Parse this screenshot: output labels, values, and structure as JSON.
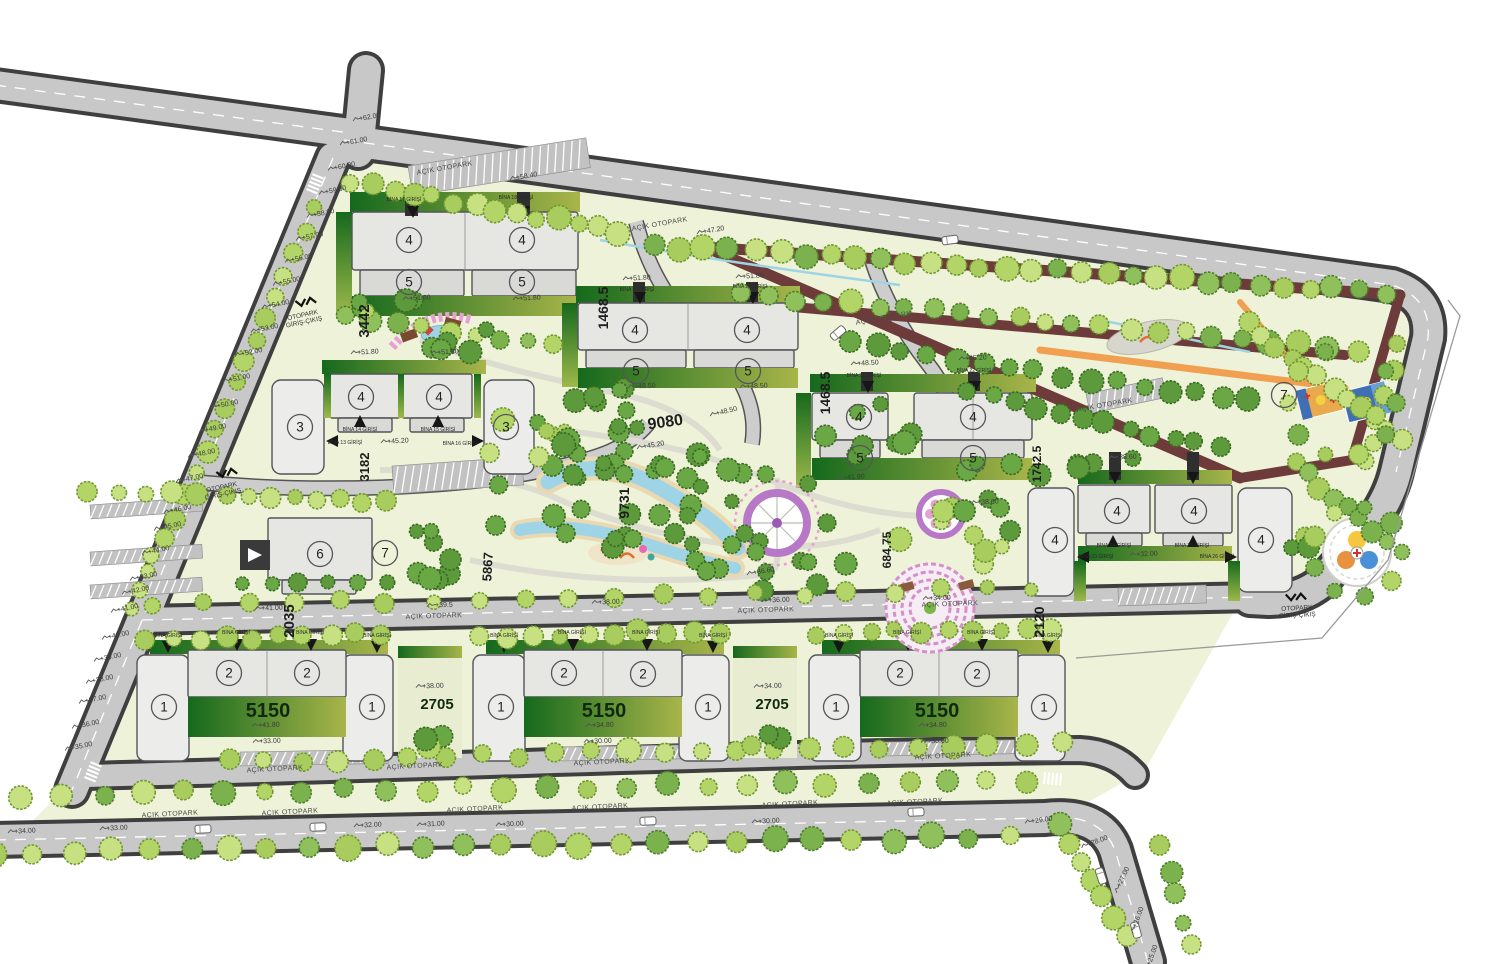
{
  "plan_title": "Site master plan",
  "palette": {
    "road_fill": "#c8c8c8",
    "road_casing": "#3f3f3f",
    "ground": "#eef2d8",
    "building": "#e6e6e3",
    "building_stroke": "#54545a",
    "lawn_dark": "#1b7a1f",
    "lawn_light": "#a4b84a",
    "track": "#6e3b3b",
    "orange_path": "#f0a050",
    "water": "#9fd4e6",
    "tree_lime": "#b9d977",
    "tree_green": "#7cb24e",
    "tree_dark": "#5c9a3c",
    "plaza_ring": "#b878c8",
    "flower_pink": "#e8a0d4"
  },
  "labels": {
    "elevations": [
      {
        "t": "+62.00",
        "x": 370,
        "y": 119,
        "r": -10
      },
      {
        "t": "+61.00",
        "x": 357,
        "y": 143,
        "r": -10
      },
      {
        "t": "+60.00",
        "x": 345,
        "y": 168,
        "r": -12
      },
      {
        "t": "+59.00",
        "x": 336,
        "y": 192,
        "r": -12
      },
      {
        "t": "+58.00",
        "x": 324,
        "y": 215,
        "r": -12
      },
      {
        "t": "+57.00",
        "x": 313,
        "y": 238,
        "r": -12
      },
      {
        "t": "+56.00",
        "x": 302,
        "y": 260,
        "r": -12
      },
      {
        "t": "+55.00",
        "x": 290,
        "y": 283,
        "r": -12
      },
      {
        "t": "+54.00",
        "x": 279,
        "y": 306,
        "r": -12
      },
      {
        "t": "+53.00",
        "x": 268,
        "y": 330,
        "r": -12
      },
      {
        "t": "+52.00",
        "x": 252,
        "y": 354,
        "r": -12
      },
      {
        "t": "+51.00",
        "x": 240,
        "y": 380,
        "r": -12
      },
      {
        "t": "+50.00",
        "x": 228,
        "y": 406,
        "r": -12
      },
      {
        "t": "+49.00",
        "x": 216,
        "y": 430,
        "r": -12
      },
      {
        "t": "+48.00",
        "x": 205,
        "y": 455,
        "r": -12
      },
      {
        "t": "+47.00",
        "x": 193,
        "y": 480,
        "r": -12
      },
      {
        "t": "+46.00",
        "x": 181,
        "y": 511,
        "r": -12
      },
      {
        "t": "+45.00",
        "x": 171,
        "y": 528,
        "r": -12
      },
      {
        "t": "+44.00",
        "x": 159,
        "y": 552,
        "r": -12
      },
      {
        "t": "+43.00",
        "x": 147,
        "y": 578,
        "r": -12
      },
      {
        "t": "+42.00",
        "x": 139,
        "y": 592,
        "r": -12
      },
      {
        "t": "+41.00",
        "x": 128,
        "y": 610,
        "r": -12
      },
      {
        "t": "+40.00",
        "x": 119,
        "y": 637,
        "r": -12
      },
      {
        "t": "+39.00",
        "x": 111,
        "y": 659,
        "r": -12
      },
      {
        "t": "+38.00",
        "x": 103,
        "y": 681,
        "r": -12
      },
      {
        "t": "+37.00",
        "x": 96,
        "y": 701,
        "r": -12
      },
      {
        "t": "+36.00",
        "x": 89,
        "y": 726,
        "r": -12
      },
      {
        "t": "+35.00",
        "x": 82,
        "y": 748,
        "r": -12
      },
      {
        "t": "+34.00",
        "x": 25,
        "y": 833,
        "r": -3
      },
      {
        "t": "+33.00",
        "x": 117,
        "y": 830,
        "r": -3
      },
      {
        "t": "+32.00",
        "x": 371,
        "y": 827,
        "r": -3
      },
      {
        "t": "+31.00",
        "x": 434,
        "y": 826,
        "r": -3
      },
      {
        "t": "+30.00",
        "x": 513,
        "y": 826,
        "r": -3
      },
      {
        "t": "+30.00",
        "x": 769,
        "y": 823,
        "r": -3
      },
      {
        "t": "+29.00",
        "x": 1042,
        "y": 822,
        "r": -8
      },
      {
        "t": "+28.00",
        "x": 1098,
        "y": 843,
        "r": -20
      },
      {
        "t": "+27.00",
        "x": 1125,
        "y": 878,
        "r": -65
      },
      {
        "t": "+26.00",
        "x": 1140,
        "y": 918,
        "r": -70
      },
      {
        "t": "+25.00",
        "x": 1154,
        "y": 956,
        "r": -70
      },
      {
        "t": "+41.00",
        "x": 272,
        "y": 610,
        "r": -2
      },
      {
        "t": "+39.5",
        "x": 444,
        "y": 607,
        "r": -2
      },
      {
        "t": "+38.00",
        "x": 609,
        "y": 604,
        "r": -2
      },
      {
        "t": "+36.00",
        "x": 779,
        "y": 602,
        "r": -2
      },
      {
        "t": "+34.00",
        "x": 940,
        "y": 600,
        "r": -2
      },
      {
        "t": "+58.40",
        "x": 527,
        "y": 178,
        "r": -10
      },
      {
        "t": "+47.20",
        "x": 714,
        "y": 232,
        "r": -10
      },
      {
        "t": "+51.80",
        "x": 420,
        "y": 300,
        "r": -3
      },
      {
        "t": "+51.80",
        "x": 530,
        "y": 300,
        "r": -3
      },
      {
        "t": "+51.80",
        "x": 640,
        "y": 280,
        "r": -3
      },
      {
        "t": "+51.80",
        "x": 753,
        "y": 278,
        "r": -3
      },
      {
        "t": "+51.80",
        "x": 368,
        "y": 354,
        "r": -3
      },
      {
        "t": "+51.80",
        "x": 448,
        "y": 354,
        "r": -3
      },
      {
        "t": "+48.50",
        "x": 645,
        "y": 388,
        "r": -3
      },
      {
        "t": "+48.50",
        "x": 757,
        "y": 388,
        "r": -3
      },
      {
        "t": "+48.50",
        "x": 727,
        "y": 413,
        "r": -14
      },
      {
        "t": "+45.20",
        "x": 398,
        "y": 443,
        "r": -3
      },
      {
        "t": "+45.20",
        "x": 654,
        "y": 447,
        "r": -10
      },
      {
        "t": "+48.50",
        "x": 868,
        "y": 365,
        "r": -3
      },
      {
        "t": "+45.20",
        "x": 976,
        "y": 360,
        "r": -3
      },
      {
        "t": "+41.90",
        "x": 854,
        "y": 479,
        "r": -3
      },
      {
        "t": "+38.60",
        "x": 988,
        "y": 504,
        "r": -3
      },
      {
        "t": "+38.60",
        "x": 1126,
        "y": 459,
        "r": -3
      },
      {
        "t": "+36.60",
        "x": 764,
        "y": 573,
        "r": -10
      },
      {
        "t": "+32.00",
        "x": 1147,
        "y": 556,
        "r": -3
      },
      {
        "t": "+41.80",
        "x": 269,
        "y": 727,
        "r": -2
      },
      {
        "t": "+33.00",
        "x": 270,
        "y": 743,
        "r": -2
      },
      {
        "t": "+34.80",
        "x": 603,
        "y": 727,
        "r": -2
      },
      {
        "t": "+30.00",
        "x": 601,
        "y": 743,
        "r": -2
      },
      {
        "t": "+34.80",
        "x": 936,
        "y": 727,
        "r": -2
      },
      {
        "t": "+30.60",
        "x": 938,
        "y": 743,
        "r": -2
      },
      {
        "t": "+38.00",
        "x": 433,
        "y": 688,
        "r": -2
      },
      {
        "t": "+34.00",
        "x": 771,
        "y": 688,
        "r": -2
      }
    ],
    "parking": [
      {
        "t": "AÇIK OTOPARK",
        "x": 445,
        "y": 170,
        "r": -10
      },
      {
        "t": "AÇIK OTOPARK",
        "x": 660,
        "y": 226,
        "r": -10
      },
      {
        "t": "AÇIK OTOPARK",
        "x": 884,
        "y": 320,
        "r": -10
      },
      {
        "t": "AÇIK OTOPARK",
        "x": 1105,
        "y": 407,
        "r": -10
      },
      {
        "t": "AÇIK OTOPARK",
        "x": 434,
        "y": 618,
        "r": -2
      },
      {
        "t": "AÇIK OTOPARK",
        "x": 766,
        "y": 612,
        "r": -2
      },
      {
        "t": "AÇIK OTOPARK",
        "x": 950,
        "y": 606,
        "r": -2
      },
      {
        "t": "AÇIK OTOPARK",
        "x": 275,
        "y": 771,
        "r": -3
      },
      {
        "t": "AÇIK OTOPARK",
        "x": 415,
        "y": 768,
        "r": -3
      },
      {
        "t": "AÇIK OTOPARK",
        "x": 602,
        "y": 764,
        "r": -3
      },
      {
        "t": "AÇIK OTOPARK",
        "x": 943,
        "y": 758,
        "r": -3
      },
      {
        "t": "AÇIK OTOPARK",
        "x": 170,
        "y": 816,
        "r": -3
      },
      {
        "t": "AÇIK OTOPARK",
        "x": 290,
        "y": 814,
        "r": -3
      },
      {
        "t": "AÇIK OTOPARK",
        "x": 475,
        "y": 811,
        "r": -3
      },
      {
        "t": "AÇIK OTOPARK",
        "x": 600,
        "y": 809,
        "r": -3
      },
      {
        "t": "AÇIK OTOPARK",
        "x": 790,
        "y": 806,
        "r": -3
      },
      {
        "t": "AÇIK OTOPARK",
        "x": 915,
        "y": 804,
        "r": -3
      }
    ],
    "gates": [
      {
        "l1": "OTOPARK",
        "l2": "GİRİŞ-ÇIKIŞ",
        "x": 303,
        "y": 317,
        "r": -12
      },
      {
        "l1": "OTOPARK",
        "l2": "GİRİŞ-ÇIKIŞ",
        "x": 222,
        "y": 489,
        "r": -12
      },
      {
        "l1": "OTOPARK",
        "l2": "GİRİŞ-ÇIKIŞ",
        "x": 1297,
        "y": 610,
        "r": -3
      }
    ],
    "entrances": [
      {
        "t": "BİNA 17 GİRİŞİ",
        "x": 404,
        "y": 201
      },
      {
        "t": "BİNA 18 GİRİŞİ",
        "x": 516,
        "y": 199
      },
      {
        "t": "BİNA 19 GİRİŞİ",
        "x": 637,
        "y": 291
      },
      {
        "t": "BİNA 20 GİRİŞİ",
        "x": 750,
        "y": 288
      },
      {
        "t": "BİNA 21 GİRİŞİ",
        "x": 864,
        "y": 377
      },
      {
        "t": "BİNA 22 GİRİŞİ",
        "x": 974,
        "y": 372
      },
      {
        "t": "BİNA 13 GİRİŞİ",
        "x": 345,
        "y": 444
      },
      {
        "t": "BİNA 14 GİRİŞİ",
        "x": 360,
        "y": 431
      },
      {
        "t": "BİNA 15 GİRİŞİ",
        "x": 438,
        "y": 431
      },
      {
        "t": "BİNA 16 GİRİŞİ",
        "x": 460,
        "y": 445
      },
      {
        "t": "BİNA 23 GİRİŞİ",
        "x": 1096,
        "y": 558
      },
      {
        "t": "BİNA 24 GİRİŞİ",
        "x": 1114,
        "y": 547
      },
      {
        "t": "BİNA 25 GİRİŞİ",
        "x": 1192,
        "y": 547
      },
      {
        "t": "BİNA 26 GİRİŞİ",
        "x": 1217,
        "y": 558
      },
      {
        "t": "BİNA GİRİŞİ",
        "x": 168,
        "y": 637
      },
      {
        "t": "BİNA GİRİŞİ",
        "x": 236,
        "y": 634
      },
      {
        "t": "BİNA GİRİŞİ",
        "x": 310,
        "y": 634
      },
      {
        "t": "BİNA GİRİŞİ",
        "x": 377,
        "y": 637
      },
      {
        "t": "BİNA GİRİŞİ",
        "x": 504,
        "y": 637
      },
      {
        "t": "BİNA GİRİŞİ",
        "x": 572,
        "y": 634
      },
      {
        "t": "BİNA GİRİŞİ",
        "x": 646,
        "y": 634
      },
      {
        "t": "BİNA GİRİŞİ",
        "x": 713,
        "y": 637
      },
      {
        "t": "BİNA GİRİŞİ",
        "x": 839,
        "y": 637
      },
      {
        "t": "BİNA GİRİŞİ",
        "x": 907,
        "y": 634
      },
      {
        "t": "BİNA GİRİŞİ",
        "x": 981,
        "y": 634
      },
      {
        "t": "BİNA GİRİŞİ",
        "x": 1048,
        "y": 637
      }
    ],
    "areas": [
      {
        "t": "3442",
        "x": 369,
        "y": 321,
        "r": -90,
        "s": 15
      },
      {
        "t": "1468.5",
        "x": 608,
        "y": 308,
        "r": -90,
        "s": 14
      },
      {
        "t": "1468.5",
        "x": 830,
        "y": 393,
        "r": -90,
        "s": 14
      },
      {
        "t": "9080",
        "x": 666,
        "y": 427,
        "r": -8,
        "s": 16
      },
      {
        "t": "9731",
        "x": 629,
        "y": 503,
        "r": -90,
        "s": 14
      },
      {
        "t": "5867",
        "x": 492,
        "y": 567,
        "r": -87,
        "s": 13
      },
      {
        "t": "2035",
        "x": 294,
        "y": 621,
        "r": -90,
        "s": 15
      },
      {
        "t": "684.75",
        "x": 891,
        "y": 550,
        "r": -90,
        "s": 12
      },
      {
        "t": "1742.5",
        "x": 1041,
        "y": 464,
        "r": -90,
        "s": 12
      },
      {
        "t": "2120",
        "x": 1044,
        "y": 622,
        "r": -90,
        "s": 14
      },
      {
        "t": "3182",
        "x": 369,
        "y": 467,
        "r": -90,
        "s": 13
      }
    ],
    "strips": [
      {
        "t": "5150",
        "x": 268,
        "y": 717,
        "s": 20
      },
      {
        "t": "5150",
        "x": 604,
        "y": 717,
        "s": 20
      },
      {
        "t": "5150",
        "x": 937,
        "y": 717,
        "s": 20
      },
      {
        "t": "2705",
        "x": 437,
        "y": 709,
        "s": 15
      },
      {
        "t": "2705",
        "x": 772,
        "y": 709,
        "s": 15
      }
    ],
    "units": [
      {
        "t": "4",
        "x": 409,
        "y": 240
      },
      {
        "t": "4",
        "x": 522,
        "y": 240
      },
      {
        "t": "5",
        "x": 409,
        "y": 282
      },
      {
        "t": "5",
        "x": 522,
        "y": 282
      },
      {
        "t": "4",
        "x": 635,
        "y": 330
      },
      {
        "t": "4",
        "x": 747,
        "y": 330
      },
      {
        "t": "5",
        "x": 636,
        "y": 371
      },
      {
        "t": "5",
        "x": 748,
        "y": 371
      },
      {
        "t": "3",
        "x": 300,
        "y": 427
      },
      {
        "t": "4",
        "x": 361,
        "y": 397
      },
      {
        "t": "4",
        "x": 439,
        "y": 397
      },
      {
        "t": "3",
        "x": 506,
        "y": 427
      },
      {
        "t": "4",
        "x": 859,
        "y": 417
      },
      {
        "t": "4",
        "x": 973,
        "y": 417
      },
      {
        "t": "5",
        "x": 860,
        "y": 458
      },
      {
        "t": "5",
        "x": 973,
        "y": 458
      },
      {
        "t": "4",
        "x": 1055,
        "y": 540
      },
      {
        "t": "4",
        "x": 1117,
        "y": 511
      },
      {
        "t": "4",
        "x": 1194,
        "y": 511
      },
      {
        "t": "4",
        "x": 1261,
        "y": 540
      },
      {
        "t": "6",
        "x": 320,
        "y": 554
      },
      {
        "t": "7",
        "x": 385,
        "y": 553
      },
      {
        "t": "7",
        "x": 1284,
        "y": 395
      },
      {
        "t": "1",
        "x": 164,
        "y": 707
      },
      {
        "t": "2",
        "x": 229,
        "y": 673
      },
      {
        "t": "2",
        "x": 307,
        "y": 673
      },
      {
        "t": "1",
        "x": 372,
        "y": 707
      },
      {
        "t": "1",
        "x": 501,
        "y": 707
      },
      {
        "t": "2",
        "x": 564,
        "y": 673
      },
      {
        "t": "2",
        "x": 643,
        "y": 674
      },
      {
        "t": "1",
        "x": 708,
        "y": 707
      },
      {
        "t": "1",
        "x": 836,
        "y": 707
      },
      {
        "t": "2",
        "x": 900,
        "y": 673
      },
      {
        "t": "2",
        "x": 977,
        "y": 674
      },
      {
        "t": "1",
        "x": 1044,
        "y": 707
      }
    ]
  }
}
